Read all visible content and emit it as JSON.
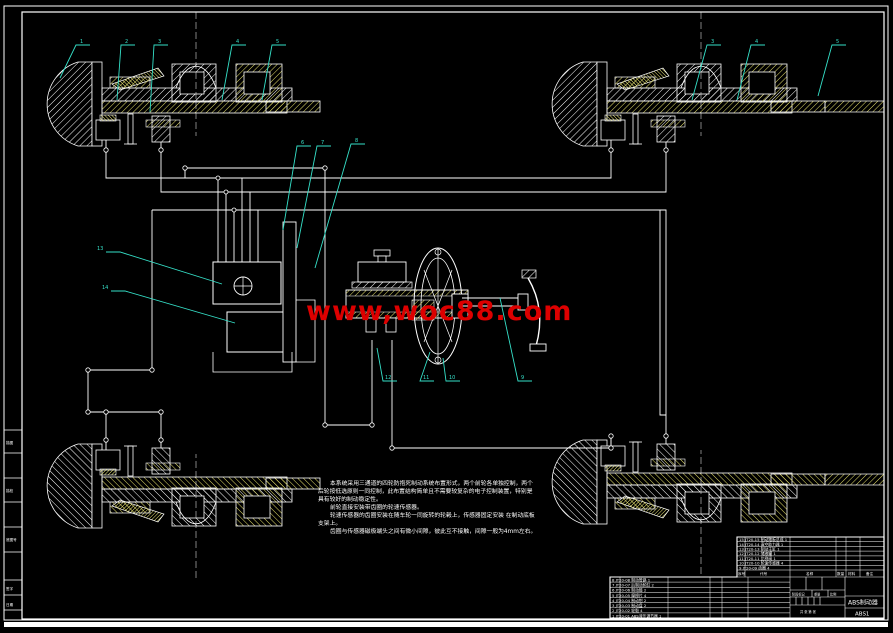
{
  "sheet": {
    "background": "#000000",
    "line_color": "#ffffff",
    "leader_color": "#35e0c8",
    "hatch_yellow": "#e6e06a",
    "watermark_red": "#dd0000"
  },
  "watermark": {
    "text": "www,woc88.com"
  },
  "leaders": {
    "labels": [
      "1",
      "2",
      "3",
      "4",
      "5",
      "6",
      "7",
      "8",
      "12",
      "11",
      "10",
      "9",
      "13",
      "14",
      "3",
      "4",
      "5"
    ]
  },
  "notes": {
    "lines": [
      "本系统采用三通道的四轮防抱死制动系统布置形式，两个前轮各单独控制，两个",
      "后轮按低选原则一同控制，此布置结构简单且不需要较复杂的电子控制装置，特别是",
      "具有较好的制动稳定性。",
      "前轮直接安装带齿圈的轮速传感器。",
      "轮速传感器的齿圈安装在随车轮一同旋转的轮毂上，传感器固定安装 在制动底板",
      "支架上。",
      "齿圈与传感器磁极端头之间有微小间隙，彼此互不接触，间隙一般为4mm左右。"
    ]
  },
  "title_block": {
    "drawing_name": "ABS制动器",
    "drawing_number": "ABS1",
    "header": {
      "no": "序号",
      "code": "代号",
      "name": "名称",
      "qty": "数量",
      "material": "材料",
      "remark": "备注"
    },
    "stamp": {
      "stage": "阶段标记",
      "weight": "重量",
      "scale": "比例",
      "sheet": "共 张 第 张"
    },
    "bom_upper": [
      "15  JT20-15  制动踏板总成  1",
      "14  JT20-14  真空助力器  1",
      "13  JT20-13  制动主缸  1",
      "12  JT20-12  储液罐  1",
      "11  JT20-11  比例阀  1",
      "10  JT20-10  轮速传感器  4",
      "9   JT20-09  齿圈  4"
    ],
    "bom_lower": [
      "8  JT20-08  制动管路  1",
      "7  JT20-07  后制动轮缸  2",
      "6  JT20-06  制动鼓  2",
      "5  JT20-05  摩擦片  4",
      "4  JT20-04  制动钳  2",
      "3  JT20-03  制动盘  2",
      "2  JT20-02  轮毂  4",
      "1  JT20-01  ABS液压调节器  1"
    ]
  },
  "margin_boxes": [
    "描图",
    "描校",
    "底图号",
    "签字",
    "日期"
  ]
}
